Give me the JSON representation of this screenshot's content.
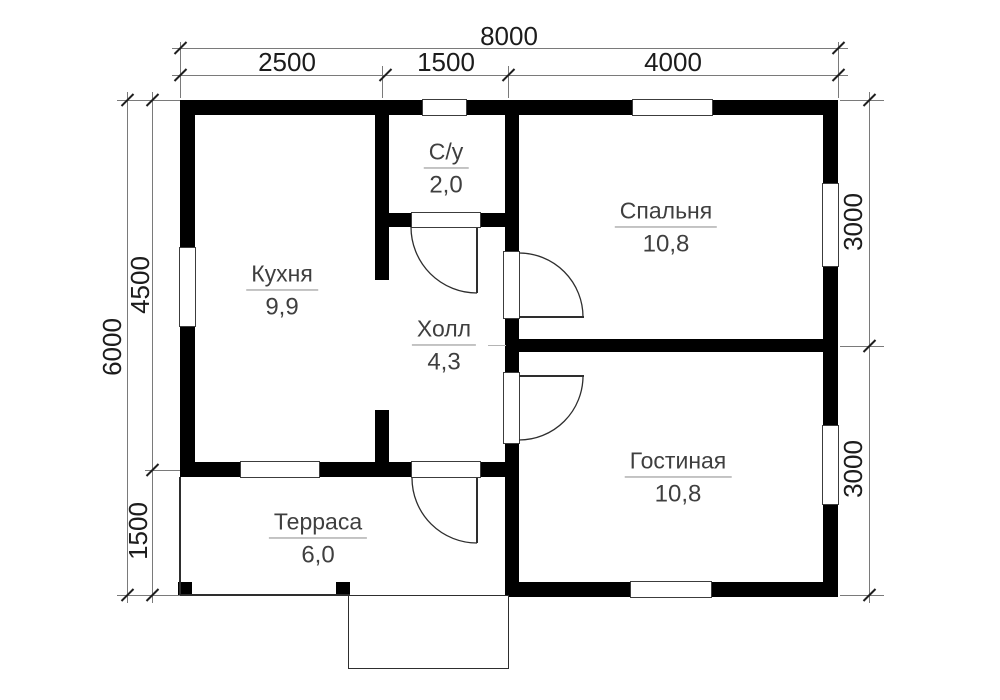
{
  "drawing": {
    "rooms": [
      {
        "name": "Кухня",
        "area": "9,9"
      },
      {
        "name": "С/у",
        "area": "2,0"
      },
      {
        "name": "Холл",
        "area": "4,3"
      },
      {
        "name": "Спальня",
        "area": "10,8"
      },
      {
        "name": "Гостиная",
        "area": "10,8"
      },
      {
        "name": "Терраса",
        "area": "6,0"
      }
    ],
    "dimensions": {
      "top_total": "8000",
      "top_segments": [
        "2500",
        "1500",
        "4000"
      ],
      "left_total": "6000",
      "left_segments": [
        "4500",
        "1500"
      ],
      "right_segments": [
        "3000",
        "3000"
      ]
    },
    "colors": {
      "wall": "#000000",
      "background": "#ffffff",
      "dimension_line": "#7a7a7a",
      "label_text": "#3f3f3f"
    }
  }
}
